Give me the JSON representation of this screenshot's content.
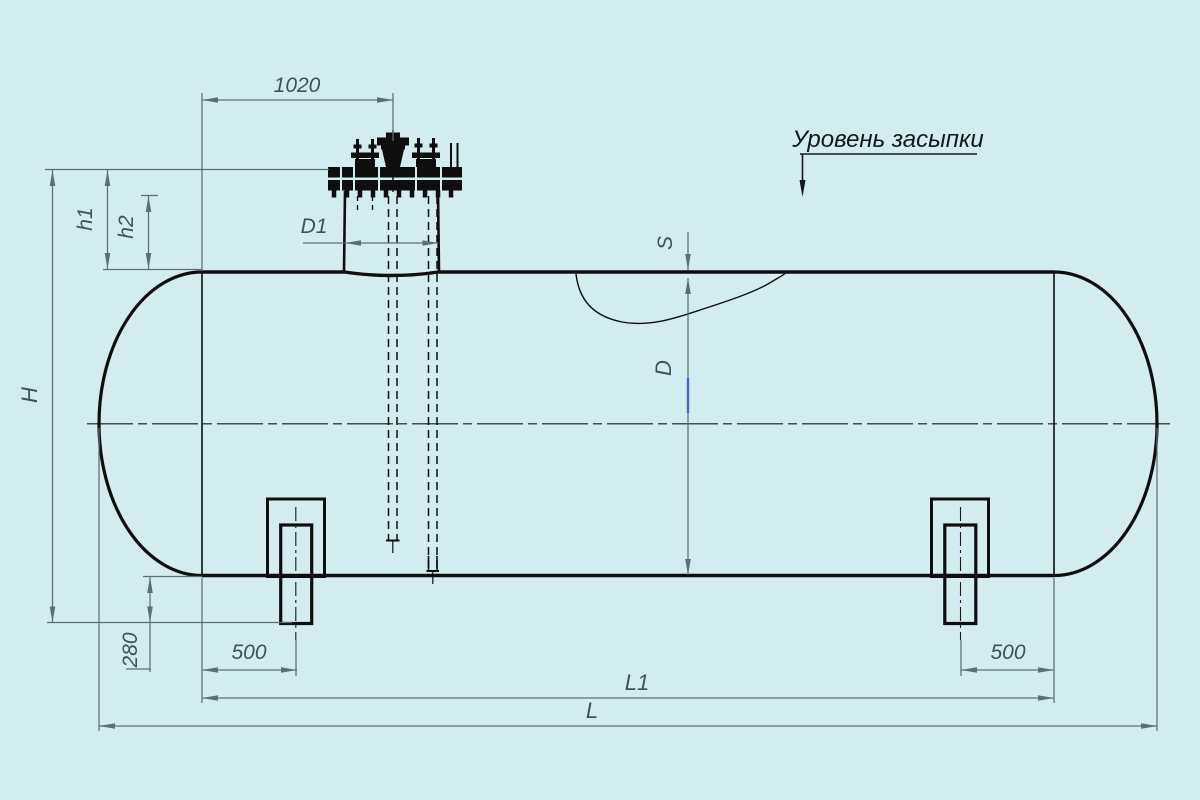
{
  "colors": {
    "bg": "#d2ecef",
    "ink": "#0e0e0e",
    "dim": "#5e6e76",
    "label": "#43505a",
    "accent": "#4668b8"
  },
  "annotation": {
    "backfill_level": "Уровень засыпки"
  },
  "dimensions": {
    "top_offset": "1020",
    "h1": "h1",
    "h2": "h2",
    "H": "H",
    "D1": "D1",
    "S": "S",
    "D": "D",
    "leg_height": "280",
    "left_leg_offset": "500",
    "right_leg_offset": "500",
    "L1": "L1",
    "L": "L"
  }
}
